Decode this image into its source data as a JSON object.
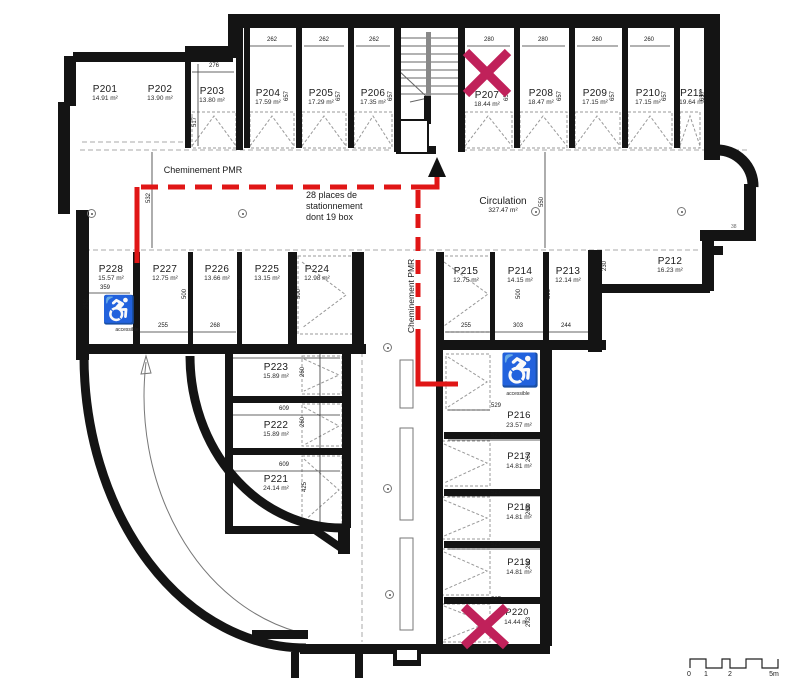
{
  "title": "Parking level floor plan",
  "colors": {
    "wall": "#141414",
    "path_red": "#e01616",
    "cross_red": "#c0215a",
    "hatch": "#999999"
  },
  "spaces": {
    "P201": {
      "label": "P201",
      "area": "14.91 m²"
    },
    "P202": {
      "label": "P202",
      "area": "13.90 m²"
    },
    "P203": {
      "label": "P203",
      "area": "13.80 m²"
    },
    "P204": {
      "label": "P204",
      "area": "17.59 m²"
    },
    "P205": {
      "label": "P205",
      "area": "17.29 m²"
    },
    "P206": {
      "label": "P206",
      "area": "17.35 m²"
    },
    "P207": {
      "label": "P207",
      "area": "18.44 m²",
      "crossed_out": true
    },
    "P208": {
      "label": "P208",
      "area": "18.47 m²"
    },
    "P209": {
      "label": "P209",
      "area": "17.15 m²"
    },
    "P210": {
      "label": "P210",
      "area": "17.15 m²"
    },
    "P211": {
      "label": "P211",
      "area": "19.64 m²"
    },
    "P212": {
      "label": "P212",
      "area": "16.23 m²"
    },
    "P213": {
      "label": "P213",
      "area": "12.14 m²"
    },
    "P214": {
      "label": "P214",
      "area": "14.15 m²"
    },
    "P215": {
      "label": "P215",
      "area": "12.75 m²"
    },
    "P216": {
      "label": "P216",
      "area": "23.57 m²",
      "accessible": true
    },
    "P217": {
      "label": "P217",
      "area": "14.81 m²"
    },
    "P218": {
      "label": "P218",
      "area": "14.81 m²"
    },
    "P219": {
      "label": "P219",
      "area": "14.81 m²"
    },
    "P220": {
      "label": "P220",
      "area": "14.44 m²",
      "crossed_out": true
    },
    "P221": {
      "label": "P221",
      "area": "24.14 m²"
    },
    "P222": {
      "label": "P222",
      "area": "15.89 m²"
    },
    "P223": {
      "label": "P223",
      "area": "15.89 m²"
    },
    "P224": {
      "label": "P224",
      "area": "12.98 m²"
    },
    "P225": {
      "label": "P225",
      "area": "13.15 m²"
    },
    "P226": {
      "label": "P226",
      "area": "13.66 m²"
    },
    "P227": {
      "label": "P227",
      "area": "12.75 m²"
    },
    "P228": {
      "label": "P228",
      "area": "15.57 m²",
      "accessible": true
    }
  },
  "texts": {
    "cheminement_pmr": "Cheminement PMR",
    "cheminement_pmr_vertical": "Cheminement PMR",
    "places_line1": "28 places de",
    "places_line2": "stationnement",
    "places_line3": "dont 19 box",
    "circulation": "Circulation",
    "circulation_area": "327.47 m²",
    "accessible": "accessible",
    "ref_38": "38"
  },
  "icons": {
    "wheelchair": "♿"
  },
  "dims": {
    "262": "262",
    "276": "276",
    "280": "280",
    "260": "260",
    "657": "657",
    "517": "517",
    "532": "532",
    "550": "550",
    "359": "359",
    "252": "252",
    "255": "255",
    "268": "268",
    "500": "500",
    "609": "609",
    "303": "303",
    "244": "244",
    "230": "230",
    "425": "425",
    "529": "529",
    "527": "527",
    "273": "273"
  },
  "scale_bar": {
    "t0": "0",
    "t1": "1",
    "t2": "2",
    "t5": "5m"
  }
}
